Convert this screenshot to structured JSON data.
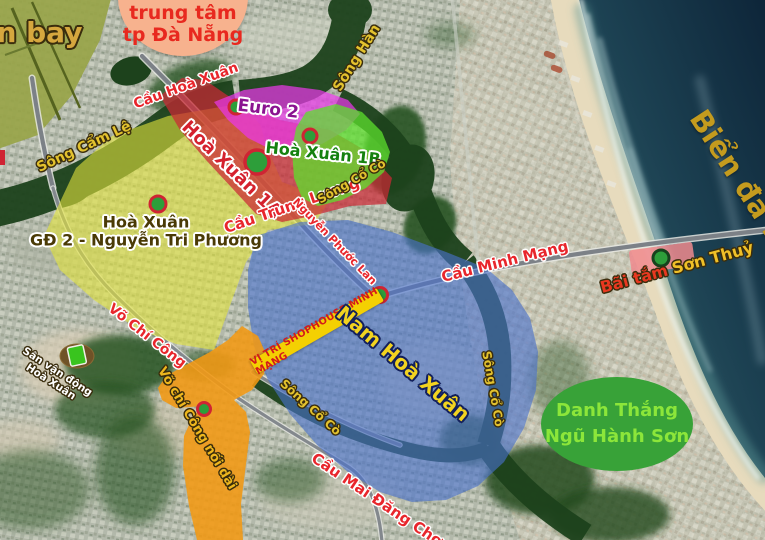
{
  "map": {
    "airport_label": "àn bay",
    "city_bubble": {
      "line1": "trung tâm",
      "line2": "tp Đà Nẵng"
    },
    "sea_label": "Biển đà nẵng",
    "rivers": {
      "song_han": "Sông Hàn",
      "song_cam_le": "Sông Cẩm Lệ",
      "song_co_co": "Sông Cổ Cò"
    },
    "bridges": {
      "hoa_xuan": "Cầu Hoà Xuân",
      "trung_luong": "Cầu Trung Lương",
      "minh_mang": "Cầu Minh Mạng",
      "mai_dang_chon": "Cầu Mai Đăng Chơn"
    },
    "streets": {
      "nguyen_phuoc_lan": "Nguyễn Phước Lan",
      "vo_chi_cong": "Võ Chí Công",
      "vo_chi_cong_extension": "Võ chí Công nối dài"
    },
    "zones": {
      "euro2": "Euro 2",
      "hoa_xuan_1a": "Hoà Xuân 1A",
      "hoa_xuan_1b": "Hoà Xuân 1B",
      "gd2_line1": "Hoà Xuân",
      "gd2_line2": "GĐ 2 - Nguyễn Tri Phương",
      "nam_hoa_xuan": "Nam Hoà Xuân"
    },
    "pois": {
      "stadium": {
        "line1": "Sân vận động",
        "line2": "Hoà Xuân"
      },
      "beach_part1": "Bãi tắm",
      "beach_part2": "Sơn Thuỷ",
      "shophouse_banner": "VỊ TRÍ SHOPHOUSE MINH MẠNG",
      "danh_thang": {
        "line1": "Danh Thắng",
        "line2": "Ngũ Hành Sơn"
      }
    },
    "colors": {
      "zone_yellow": "#e2e43c",
      "zone_red": "#cc2834",
      "zone_magenta": "#e937e9",
      "zone_green": "#5ce02c",
      "zone_blue": "#4870cc",
      "zone_orange": "#f29812",
      "marker_green": "#2d9e3a",
      "marker_ring_red": "#cf2433",
      "banner_yellow": "#f4d002",
      "bubble_salmon": "#f7b28e",
      "oval_green": "#38a238",
      "river_label_yellow": "#e3c22e",
      "bridge_label_red": "#e8262c"
    }
  }
}
